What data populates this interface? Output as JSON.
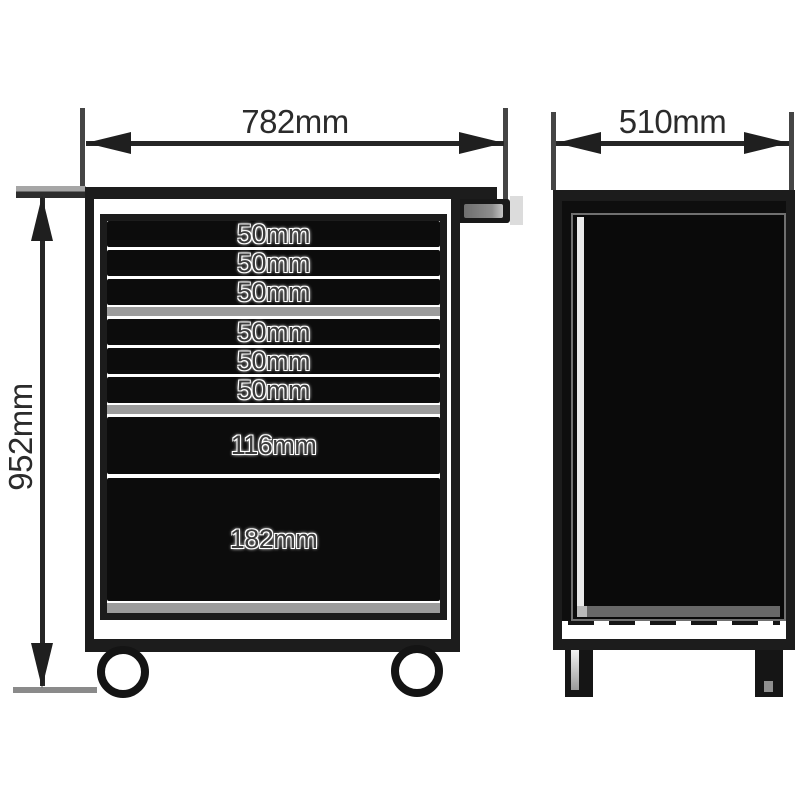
{
  "drawing": {
    "type": "technical-dimension-drawing",
    "subject": "tool trolley roller cabinet - front and side elevations",
    "colors": {
      "background": "#ffffff",
      "outline": "#1c1c1c",
      "drawer_face": "#0c0c0c",
      "rail_gray": "#9c9c9c",
      "dimension_text": "#2b2b2b",
      "drawer_label_text": "#3c3c3c"
    },
    "front_view": {
      "name": "front elevation",
      "width_dim": "782mm",
      "height_dim": "952mm",
      "drawers": [
        {
          "label": "50mm"
        },
        {
          "label": "50mm"
        },
        {
          "label": "50mm"
        },
        {
          "label": "50mm"
        },
        {
          "label": "50mm"
        },
        {
          "label": "50mm"
        },
        {
          "label": "116mm"
        },
        {
          "label": "182mm"
        }
      ]
    },
    "side_view": {
      "name": "side elevation",
      "depth_dim": "510mm"
    }
  }
}
